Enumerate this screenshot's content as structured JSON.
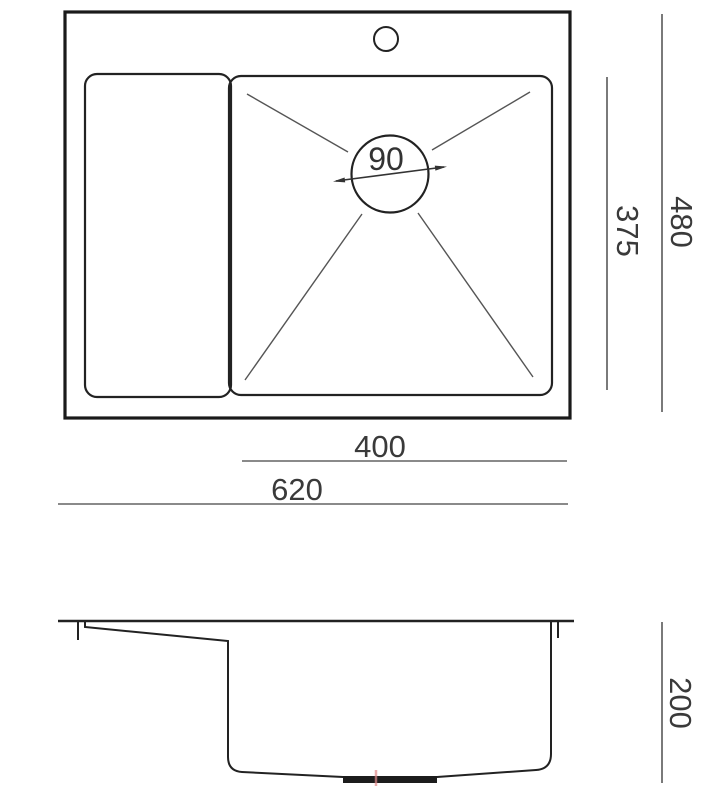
{
  "drawing_title": "sink-dimension-drawing",
  "colors": {
    "background": "#ffffff",
    "outline": "#1e1e1e",
    "thin_line": "#555555",
    "dim_line": "#6b6b6b",
    "text": "#3a3a3a",
    "drain_plate": "#1c1c1c",
    "center_mark": "#e08a8a"
  },
  "top_view": {
    "outer_width_label": "620",
    "outer_height_label": "480",
    "bowl_width_label": "400",
    "inner_height_label": "375",
    "drain_diameter_label": "90"
  },
  "side_view": {
    "depth_label": "200"
  },
  "dimensions_mm": {
    "outer_width": 620,
    "outer_depth": 480,
    "bowl_width": 400,
    "bowl_depth": 375,
    "drain_diameter": 90,
    "bowl_height": 200
  }
}
